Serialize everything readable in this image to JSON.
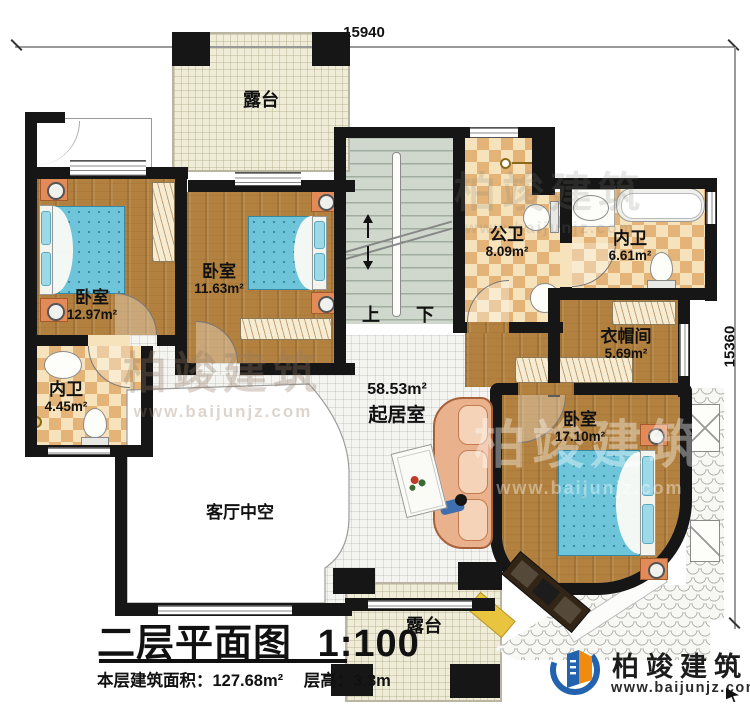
{
  "dimensions": {
    "top": "15940",
    "right": "15360"
  },
  "rooms": {
    "terrace_top": {
      "name": "露台"
    },
    "terrace_bottom": {
      "name": "露台"
    },
    "bedroom_left": {
      "name": "卧室",
      "area": "12.97m²"
    },
    "bedroom_middle": {
      "name": "卧室",
      "area": "11.63m²"
    },
    "bedroom_right": {
      "name": "卧室",
      "area": "17.10m²"
    },
    "public_bathroom": {
      "name": "公卫",
      "area": "8.09m²"
    },
    "ensuite_top_right": {
      "name": "内卫",
      "area": "6.61m²"
    },
    "ensuite_left": {
      "name": "内卫",
      "area": "4.45m²"
    },
    "cloakroom": {
      "name": "衣帽间",
      "area": "5.69m²"
    },
    "living_room": {
      "name": "起居室",
      "area": "58.53m²"
    },
    "void": {
      "name": "客厅中空"
    }
  },
  "stairs": {
    "up_label": "上",
    "down_label": "下"
  },
  "title_block": {
    "title": "二层平面图",
    "scale": "1:100",
    "area_label": "本层建筑面积：",
    "area_value": "127.68m²",
    "height_label": "层高：",
    "height_value": "3.3m"
  },
  "branding": {
    "company": "柏竣建筑",
    "website": "www.baijunjz.com"
  },
  "watermark": {
    "company": "柏竣建筑",
    "website": "www.baijunjz.com"
  },
  "colors": {
    "wall": "#161616",
    "wood_floor": "#b2813f",
    "tile_light": "#f6e3bc",
    "tile_dark": "#e3b377",
    "terrace": "#efecd8",
    "bed_blue": "#6ec5da",
    "stairs": "#d0d8cd",
    "sofa": "#e9b18c",
    "nightstand_orange": "#e28a58",
    "logo_blue": "#2262ae",
    "logo_orange": "#ef8b0e"
  }
}
